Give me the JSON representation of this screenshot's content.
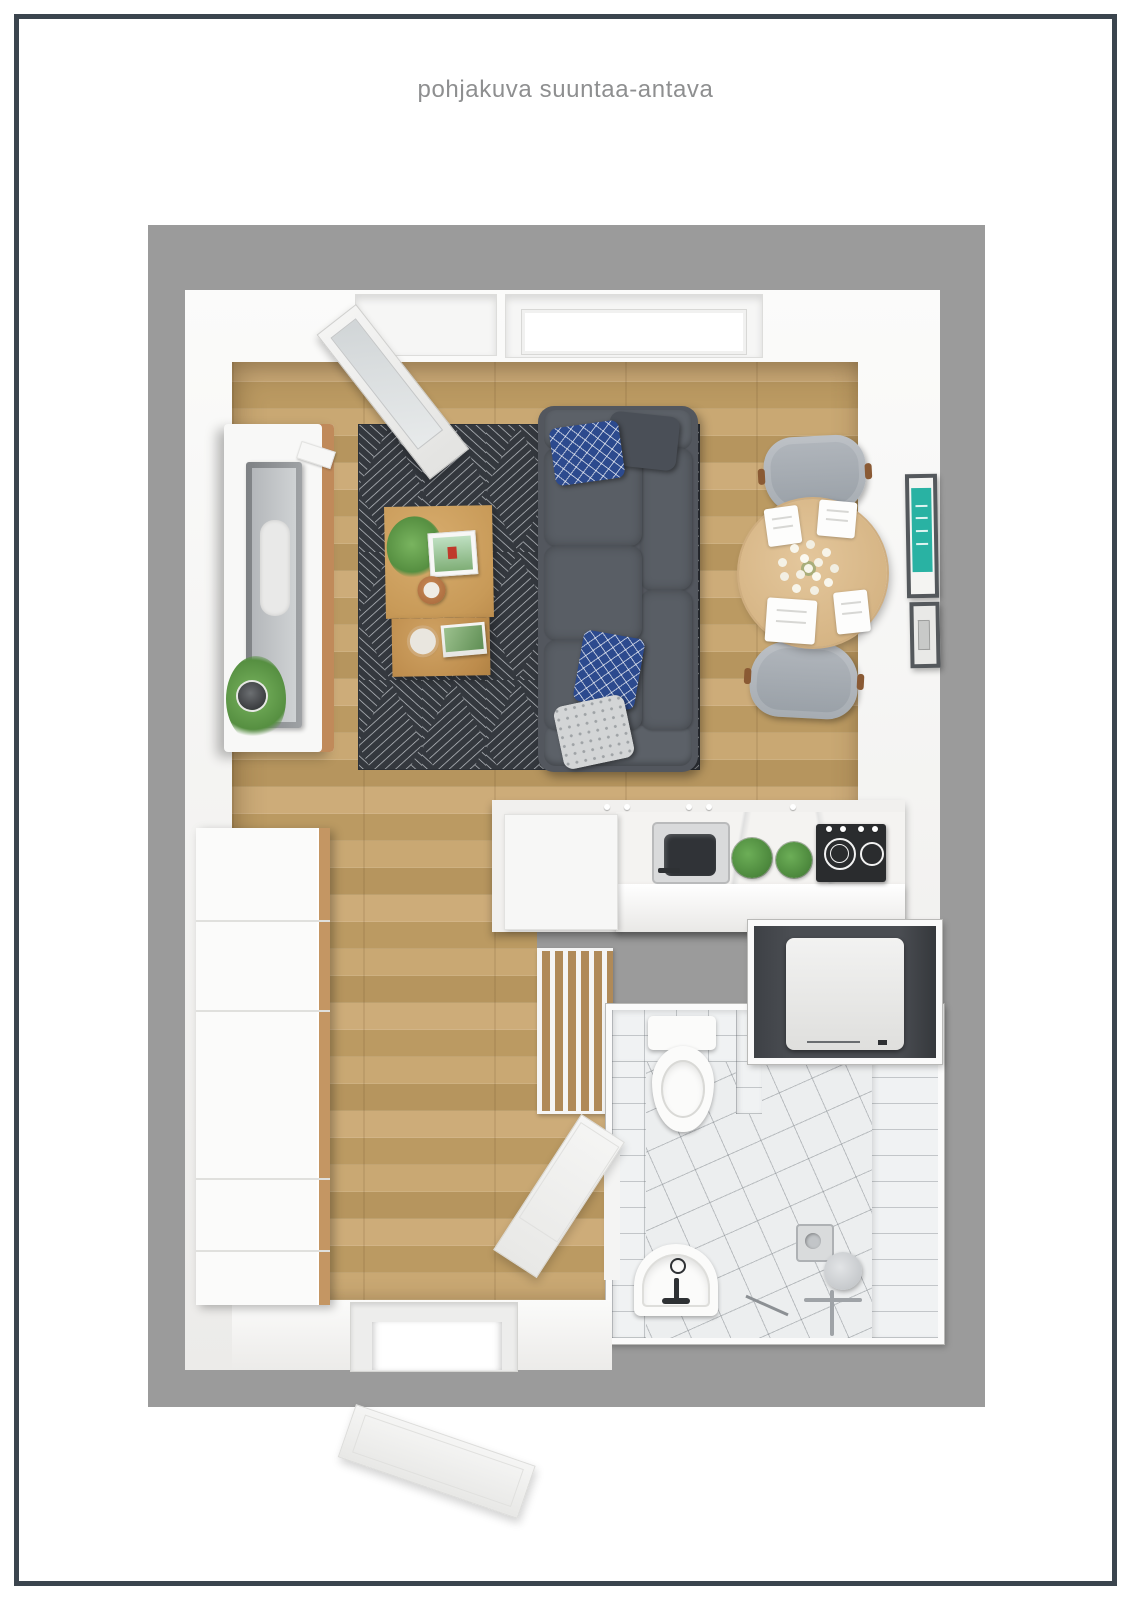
{
  "page": {
    "title": "pohjakuva suuntaa-antava"
  },
  "frame": {
    "border_color": "#3b454e",
    "page_background": "#ffffff",
    "title_color": "#8e8f90"
  },
  "floorplan": {
    "wall_outer_color": "#9b9b9b",
    "wall_inner_color": "#f2f1f0",
    "floor_wood_color": "#c2a06d",
    "rug_color": "#34383e",
    "rug_line_color": "#c2c6cb",
    "sofa_color": "#53575e",
    "pillow_navy_color": "#2c4a8e",
    "coffee_table_color": "#c89a58",
    "dining_table_color": "#d6b585",
    "chair_color": "#a5abb1",
    "artwork_accent_color": "#29b2a3",
    "stove_color": "#2a2c2e",
    "bathroom_tile_color": "#eceeef",
    "washer_niche_color": "#4a4d52",
    "rooms": [
      "living-room",
      "kitchen",
      "hallway",
      "bathroom"
    ],
    "furniture": [
      "sofa",
      "geometric-rug",
      "nesting-coffee-tables",
      "tv-sideboard",
      "round-dining-table",
      "dining-chairs",
      "flower-centerpiece",
      "wardrobe-cabinet",
      "kitchen-counter",
      "kitchen-sink",
      "induction-stove",
      "herb-plants",
      "washing-machine",
      "toilet",
      "bathroom-sink",
      "shower-set",
      "slatted-bench",
      "entry-door-open",
      "bathroom-door-open",
      "window-leaf-open",
      "wall-art-frames"
    ]
  }
}
